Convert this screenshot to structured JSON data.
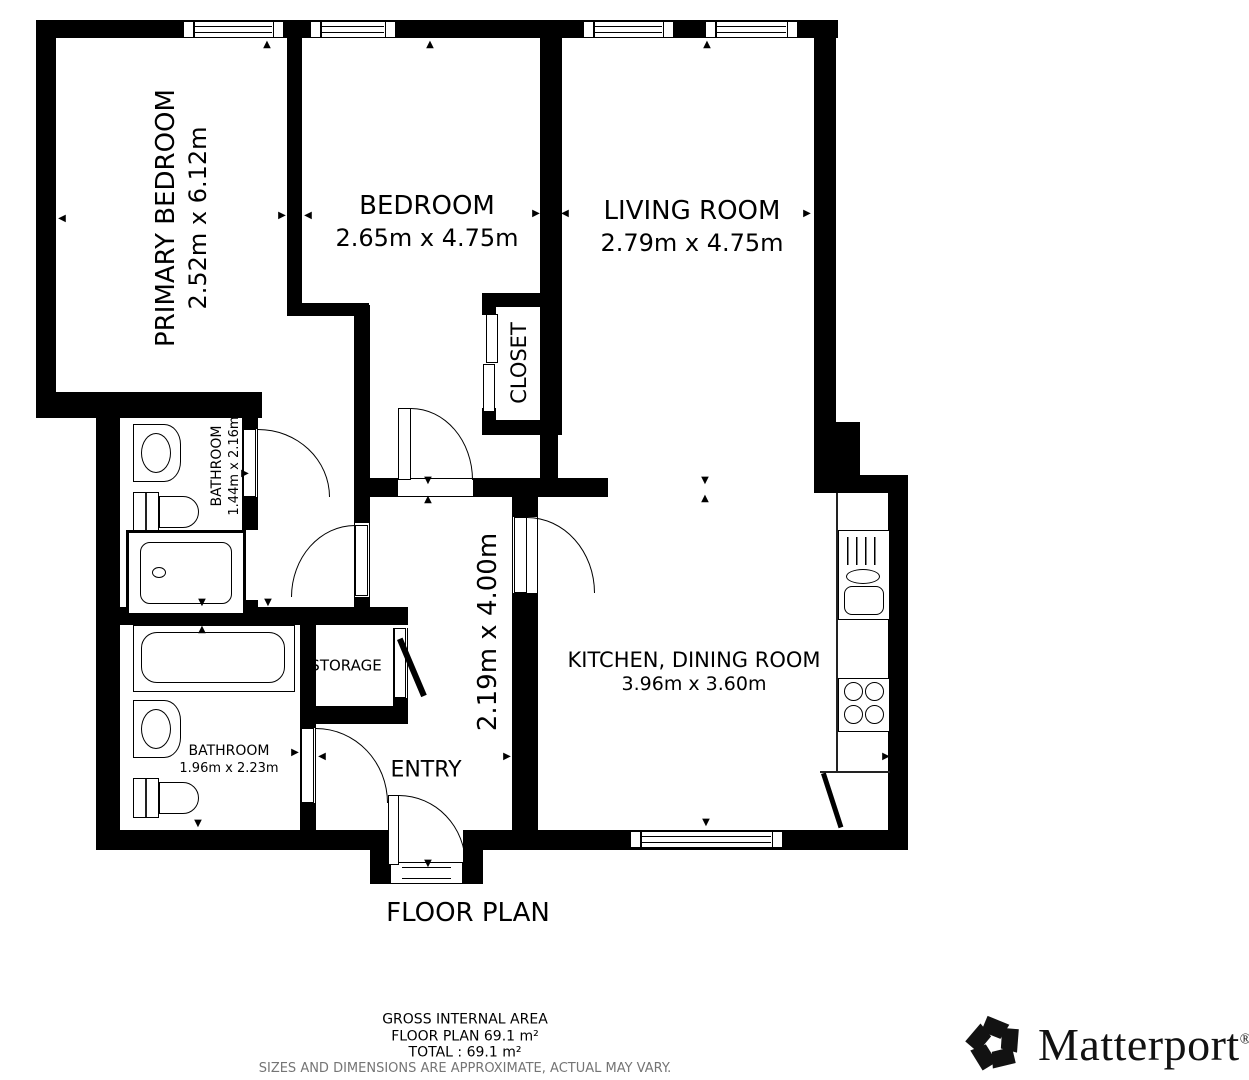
{
  "floor_plan": {
    "title": "FLOOR PLAN",
    "rooms": {
      "primary_bedroom": {
        "name": "PRIMARY BEDROOM",
        "dimensions": "2.52m x 6.12m"
      },
      "bedroom": {
        "name": "BEDROOM",
        "dimensions": "2.65m x 4.75m"
      },
      "living_room": {
        "name": "LIVING ROOM",
        "dimensions": "2.79m x 4.75m"
      },
      "closet": {
        "name": "CLOSET"
      },
      "bathroom_upper": {
        "name": "BATHROOM",
        "dimensions": "1.44m x 2.16m"
      },
      "bathroom_lower": {
        "name": "BATHROOM",
        "dimensions": "1.96m x 2.23m"
      },
      "storage": {
        "name": "STORAGE"
      },
      "entry": {
        "name": "ENTRY",
        "dimensions": "2.19m x 4.00m"
      },
      "kitchen_dining_room": {
        "name": "KITCHEN, DINING ROOM",
        "dimensions": "3.96m x 3.60m"
      }
    },
    "area_summary": {
      "gross_internal_area_label": "GROSS INTERNAL AREA",
      "floor_plan_area": "FLOOR PLAN 69.1 m²",
      "total_area": "TOTAL :  69.1 m²",
      "disclaimer": "SIZES AND DIMENSIONS ARE APPROXIMATE, ACTUAL MAY VARY."
    },
    "branding": {
      "name": "Matterport",
      "registered": "®"
    },
    "icons": {
      "arrow_up": "▲",
      "arrow_down": "▼",
      "arrow_left": "◀",
      "arrow_right": "▶"
    },
    "colors": {
      "wall": "#000000",
      "background": "#ffffff",
      "disclaimer": "#757575"
    }
  }
}
